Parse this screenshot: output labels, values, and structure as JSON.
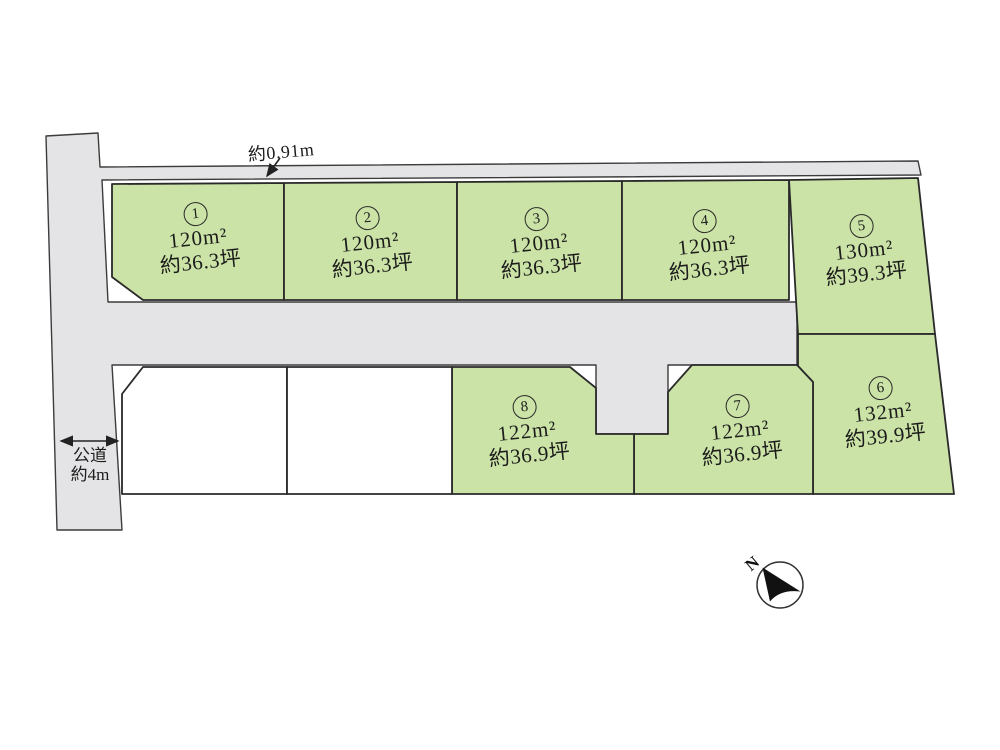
{
  "plots": [
    {
      "number": "1",
      "area": "120m²",
      "tsubo": "約36.3坪"
    },
    {
      "number": "2",
      "area": "120m²",
      "tsubo": "約36.3坪"
    },
    {
      "number": "3",
      "area": "120m²",
      "tsubo": "約36.3坪"
    },
    {
      "number": "4",
      "area": "120m²",
      "tsubo": "約36.3坪"
    },
    {
      "number": "5",
      "area": "130m²",
      "tsubo": "約39.3坪"
    },
    {
      "number": "6",
      "area": "132m²",
      "tsubo": "約39.9坪"
    },
    {
      "number": "7",
      "area": "122m²",
      "tsubo": "約36.9坪"
    },
    {
      "number": "8",
      "area": "122m²",
      "tsubo": "約36.9坪"
    }
  ],
  "annotations": {
    "setback_width": "約0.91m",
    "road_name": "公道",
    "road_width": "約4m",
    "north": "N"
  },
  "colors": {
    "plot_green": "#cbe3a6",
    "road_gray": "#e4e4e6",
    "white_lot": "#ffffff",
    "outline": "#2a2a2a",
    "road_outline": "#3c3c3c",
    "compass_black": "#111111",
    "text": "#1c1c1c"
  }
}
